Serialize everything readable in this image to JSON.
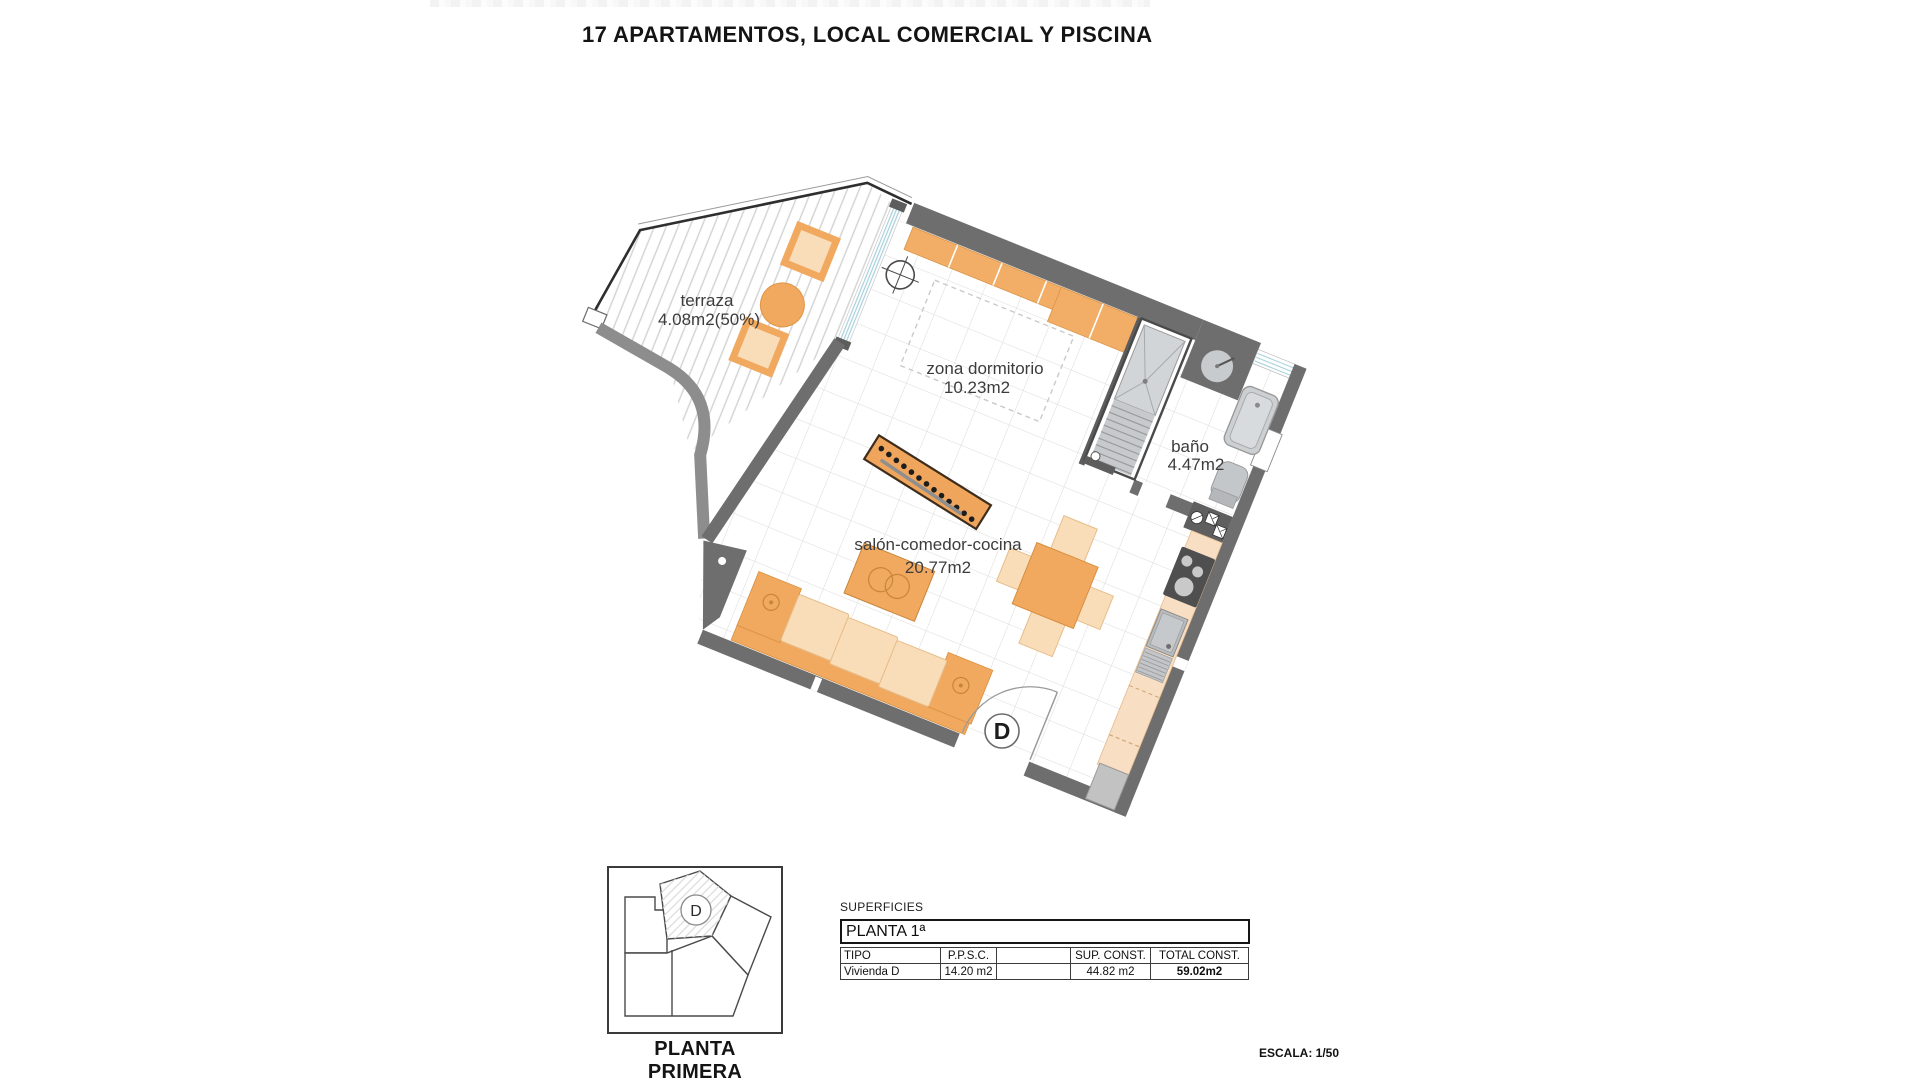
{
  "title": "17 APARTAMENTOS, LOCAL COMERCIAL Y PISCINA",
  "plan": {
    "rooms": [
      {
        "name": "terraza",
        "area": "4.08m2(50%)"
      },
      {
        "name": "zona dormitorio",
        "area": "10.23m2"
      },
      {
        "name": "baño",
        "area": "4.47m2"
      },
      {
        "name": "salón-comedor-cocina",
        "area": "20.77m2"
      }
    ],
    "door_label": "D"
  },
  "key_plan": {
    "unit_label": "D",
    "caption": "PLANTA PRIMERA"
  },
  "surfaces_table": {
    "section_label": "SUPERFICIES",
    "floor_label": "PLANTA 1ª",
    "headers": [
      "TIPO",
      "P.P.S.C.",
      "",
      "SUP. CONST.",
      "TOTAL CONST."
    ],
    "row": [
      "Vivienda D",
      "14.20 m2",
      "",
      "44.82 m2",
      "59.02m2"
    ]
  },
  "scale_label": "ESCALA: 1/50",
  "colors": {
    "wall": "#6e6e6e",
    "furniture_orange": "#f0a95f",
    "furniture_peach": "#f9ddb9",
    "counter_peach": "#f8dfc4",
    "glazing_blue": "#a8d3de",
    "stair_gray": "#c7cacc",
    "tile_line": "#dcdcdc"
  }
}
